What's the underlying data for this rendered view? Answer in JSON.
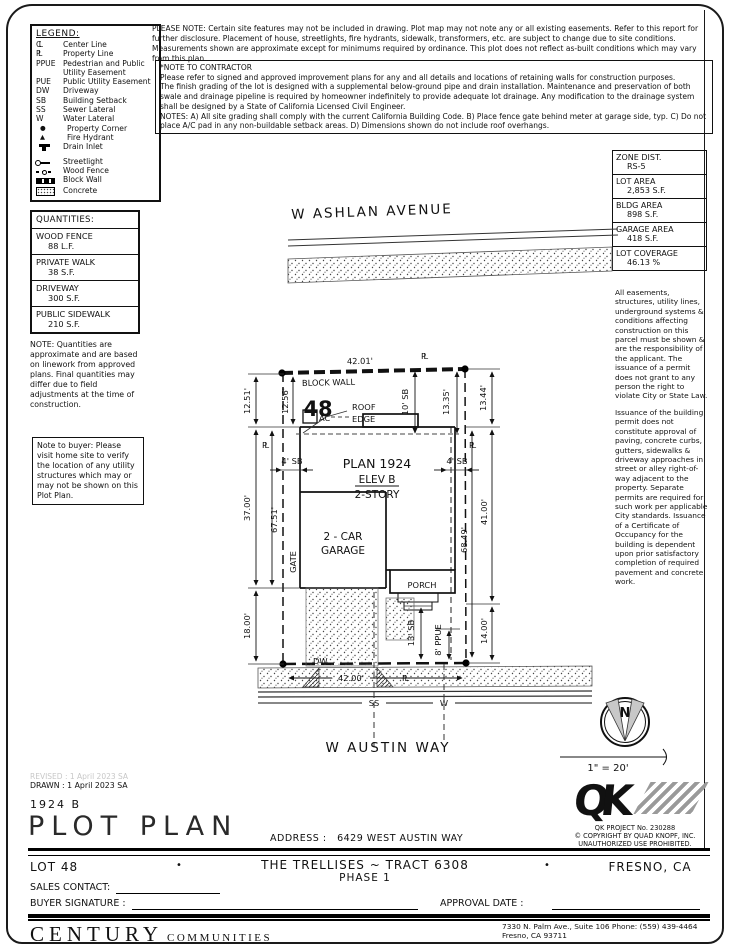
{
  "legend": {
    "title": "LEGEND:",
    "items": [
      {
        "sym": "CL",
        "label": "Center Line"
      },
      {
        "sym": "PL",
        "label": "Property Line"
      },
      {
        "sym": "PPUE",
        "label": "Pedestrian and Public Utility Easement"
      },
      {
        "sym": "PUE",
        "label": "Public Utility Easement"
      },
      {
        "sym": "DW",
        "label": "Driveway"
      },
      {
        "sym": "SB",
        "label": "Building Setback"
      },
      {
        "sym": "SS",
        "label": "Sewer Lateral"
      },
      {
        "sym": "W",
        "label": "Water Lateral"
      },
      {
        "sym": "●",
        "label": "Property Corner"
      },
      {
        "sym": "▲",
        "label": "Fire Hydrant"
      },
      {
        "sym": "",
        "label": "Drain Inlet"
      },
      {
        "sym": "",
        "label": "Streetlight"
      },
      {
        "sym": "",
        "label": "Wood Fence"
      },
      {
        "sym": "",
        "label": "Block Wall"
      },
      {
        "sym": "",
        "label": "Concrete"
      }
    ]
  },
  "notes": {
    "please_note": "PLEASE NOTE:  Certain site features may not be included in drawing.  Plot map may not note any or all existing easements. Refer to this report for further disclosure.  Placement of house, streetlights, fire hydrants, sidewalk, transformers, etc. are subject to change due to site conditions.  Measurements shown are approximate except for minimums required by ordinance.  This plot does not reflect as-built conditions which may vary from this plan.",
    "contractor_title": "*NOTE TO CONTRACTOR",
    "contractor_lines": [
      "Please refer to signed and approved improvement plans for any and all details and locations of retaining walls for construction purposes.",
      "The finish grading of the lot is designed with a supplemental below-ground pipe and drain installation.  Maintenance and preservation of both swale and drainage pipeline is required by homeowner indefinitely to provide adequate lot drainage.  Any modification to the drainage system shall be designed by a State of California Licensed Civil Engineer.",
      "NOTES:  A) All site grading shall comply with the current California Building Code.  B) Place fence gate behind meter at garage side, typ.  C) Do not place A/C pad in any non-buildable setback areas.  D) Dimensions shown do not include roof overhangs."
    ]
  },
  "quantities": {
    "title": "QUANTITIES:",
    "rows": [
      {
        "name": "WOOD FENCE",
        "value": "88 L.F."
      },
      {
        "name": "PRIVATE WALK",
        "value": "38 S.F."
      },
      {
        "name": "DRIVEWAY",
        "value": "300 S.F."
      },
      {
        "name": "PUBLIC SIDEWALK",
        "value": "210 S.F."
      }
    ],
    "note": "NOTE: Quantities are approximate and are based on linework from approved plans.  Final quantities may differ due to field adjustments at the time of construction.",
    "buyer_note": "Note to buyer: Please visit home site to verify the location of any utility structures which may or may not be shown on this Plot Plan."
  },
  "stats": {
    "rows": [
      {
        "name": "ZONE DIST.",
        "value": "RS-5"
      },
      {
        "name": "LOT AREA",
        "value": "2,853 S.F."
      },
      {
        "name": "BLDG AREA",
        "value": "898 S.F."
      },
      {
        "name": "GARAGE AREA",
        "value": "418 S.F."
      },
      {
        "name": "LOT COVERAGE",
        "value": "46.13 %"
      }
    ],
    "para1": "All easements, structures, utility lines, underground systems & conditions affecting construction on this parcel must be shown & are the responsibility of the applicant. The issuance of a permit does not grant to any person the right to violate City or State Law.",
    "para2": "Issuance of the building permit does not constitute approval of paving, concrete curbs, gutters, sidewalks & driveway approaches in street or alley right-of-way adjacent to the property. Separate permits are required for such work per applicable City standards. Issuance of a Certificate of Occupancy for the building is dependent upon prior satisfactory completion of required pavement and concrete work."
  },
  "plot": {
    "street_top": "W ASHLAN AVENUE",
    "street_bottom": "W AUSTIN WAY",
    "lot_number": "48",
    "labels": {
      "block_wall": "BLOCK WALL",
      "roof": "ROOF",
      "edge": "EDGE",
      "ac": "AC",
      "plan": "PLAN 1924",
      "elev": "ELEV B",
      "story": "2-STORY",
      "garage1": "2 - CAR",
      "garage2": "GARAGE",
      "porch": "PORCH",
      "gate": "GATE",
      "dw": "DW",
      "pl": "PL",
      "ss": "SS",
      "w": "W"
    },
    "dims": {
      "top": "42.01'",
      "bottom": "42.00'",
      "left_outer": "12.51'",
      "left_inner": "12.56'",
      "sb10": "10' SB",
      "right_inner": "13.35'",
      "right_outer": "13.44'",
      "sb4": "4' SB",
      "left_mid": "37.00'",
      "left_total": "67.51'",
      "left_low": "18.00'",
      "right_mid": "41.00'",
      "right_total": "68.49'",
      "right_low": "14.00'",
      "sb13": "13' SB",
      "ppue": "8' PPUE"
    },
    "north_label": "N",
    "scale": "1\" = 20'"
  },
  "qk": {
    "logo": "QK",
    "project": "QK PROJECT No. 230288",
    "copyright": "©  COPYRIGHT BY QUAD KNOPF, INC.",
    "notice": "UNAUTHORIZED USE PROHIBITED."
  },
  "titleblock": {
    "revised": "REVISED :  1 April 2023  SA",
    "drawn": "DRAWN :  1 April 2023  SA",
    "plan_code": "1924  B",
    "title": "PLOT PLAN",
    "address_label": "ADDRESS :",
    "address": "6429 WEST AUSTIN WAY",
    "lot": "LOT 48",
    "bullet": "•",
    "tract": "THE TRELLISES ~ TRACT 6308",
    "phase": "PHASE 1",
    "city": "FRESNO, CA",
    "sales_label": "SALES CONTACT:",
    "buyer_label": "BUYER SIGNATURE :",
    "approval_label": "APPROVAL DATE :"
  },
  "footer": {
    "brand": "CENTURY",
    "brand_suffix": "COMMUNITIES",
    "address_line1": "7330 N. Palm Ave., Suite 106    Phone:  (559) 439-4464",
    "address_line2": "Fresno, CA  93711"
  }
}
